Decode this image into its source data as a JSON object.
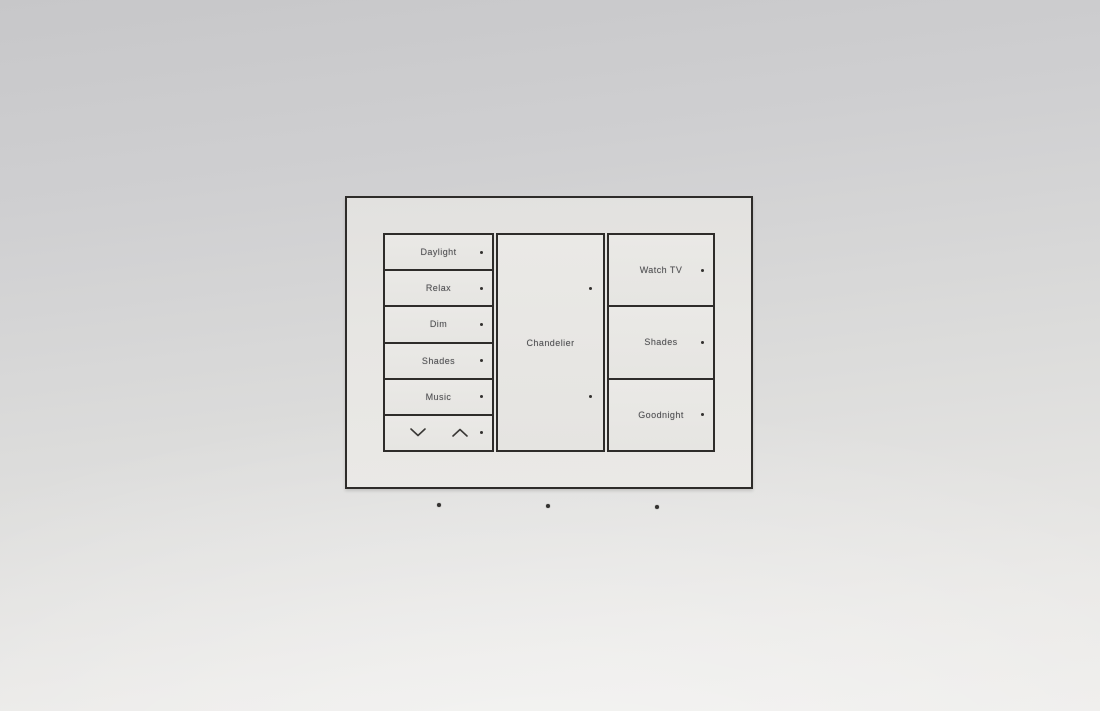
{
  "panel": {
    "left_buttons": [
      {
        "label": "Daylight"
      },
      {
        "label": "Relax"
      },
      {
        "label": "Dim"
      },
      {
        "label": "Shades"
      },
      {
        "label": "Music"
      }
    ],
    "center": {
      "label": "Chandelier"
    },
    "right_buttons": [
      {
        "label": "Watch TV"
      },
      {
        "label": "Shades"
      },
      {
        "label": "Goodnight"
      }
    ],
    "rocker": {
      "down_icon": "chevron-down",
      "up_icon": "chevron-up"
    },
    "led_count": 10
  },
  "wall": {
    "mounting_dots": 3
  },
  "colors": {
    "line": "#2e2c2a",
    "led": "#33312f",
    "label_text": "#4b4b4e",
    "faceplate_fill": "#e7e6e3",
    "wall_top": "#c7c7c9",
    "wall_bottom": "#edecea"
  }
}
